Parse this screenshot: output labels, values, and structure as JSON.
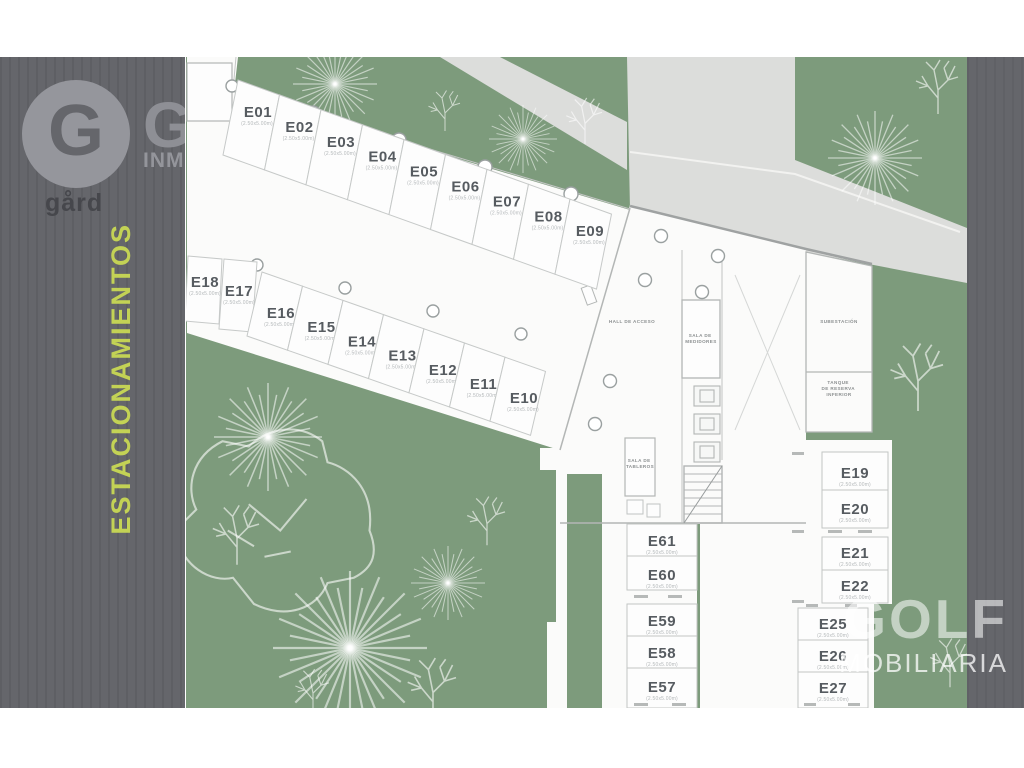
{
  "branding": {
    "logo_letter": "G",
    "logo_name": "gård",
    "partial_watermark_letter": "G",
    "partial_watermark_text": "INMOBILIARIA",
    "sidebar_title": "ESTACIONAMIENTOS",
    "golf_watermark_line1": "GOLF",
    "golf_watermark_line2": "MOBILIARIA"
  },
  "colors": {
    "sidebar_gray": "#65666b",
    "accent_green_yellow": "#c3d255",
    "landscape_green": "#7d9b7c",
    "road_gray": "#dcdddb",
    "plan_white": "#fdfdfd"
  },
  "plan": {
    "dim_note": "(2.50x5.00m)",
    "rows": {
      "row1": [
        "E01",
        "E02",
        "E03",
        "E04",
        "E05",
        "E06",
        "E07",
        "E08",
        "E09"
      ],
      "row2": [
        "E18",
        "E17",
        "E16",
        "E15",
        "E14",
        "E13",
        "E12",
        "E11",
        "E10"
      ],
      "right_block_a": [
        "E19",
        "E20"
      ],
      "right_block_b": [
        "E21",
        "E22"
      ],
      "right_block_c": [
        "E25",
        "E26",
        "E27"
      ],
      "center_block_a": [
        "E61",
        "E60"
      ],
      "center_block_b": [
        "E59",
        "E58",
        "E57"
      ]
    },
    "rooms": {
      "hall": "HALL DE ACCESO",
      "medidores": [
        "SALA DE",
        "MEDIDORES"
      ],
      "subestacion": "SUBESTACIÓN",
      "tanque": [
        "TANQUE",
        "DE RESERVA",
        "INFERIOR"
      ],
      "tableros": [
        "SALA DE",
        "TABLEROS"
      ]
    }
  }
}
